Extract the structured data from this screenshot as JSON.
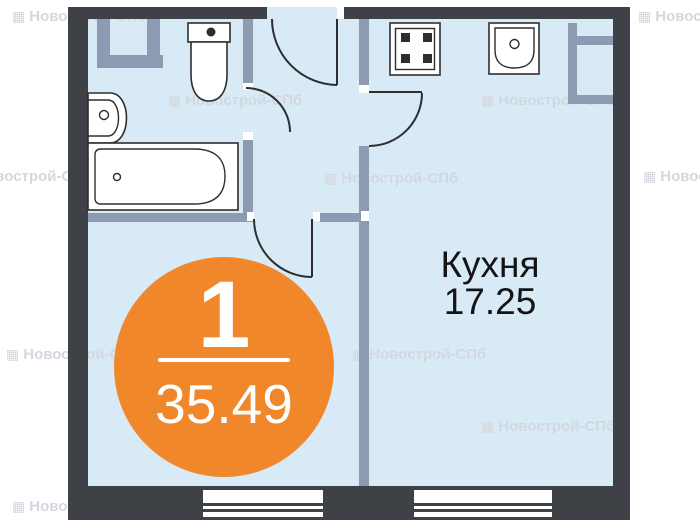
{
  "rooms": {
    "kitchen": {
      "name": "Кухня",
      "area": "17.25"
    }
  },
  "unit_badge": {
    "number": "1",
    "area": "35.49"
  },
  "watermark": {
    "icon_char": "▦",
    "text": "Новострой-СПб",
    "instances": [
      {
        "x": 12,
        "y": 8
      },
      {
        "x": 638,
        "y": 8
      },
      {
        "x": 168,
        "y": 92
      },
      {
        "x": 481,
        "y": 92
      },
      {
        "x": -42,
        "y": 168
      },
      {
        "x": 324,
        "y": 170
      },
      {
        "x": 643,
        "y": 168
      },
      {
        "x": 6,
        "y": 346
      },
      {
        "x": 352,
        "y": 346
      },
      {
        "x": 481,
        "y": 418
      },
      {
        "x": 12,
        "y": 498
      }
    ]
  },
  "fixtures": {
    "toilet": "toilet",
    "bathroom_sink": "wash-basin",
    "bathtub": "bathtub",
    "stove": "stove-4-burner",
    "kitchen_sink": "kitchen-sink",
    "vent_ducts": "ventilation-duct"
  },
  "colors": {
    "wall": "#3E4145",
    "partition": "#8C9BB2",
    "floor": "#D9EAF7",
    "accent": "#F0872B",
    "text": "#141414",
    "fixture_stroke": "#2E2E2E",
    "watermark": "#D3D8DF"
  }
}
